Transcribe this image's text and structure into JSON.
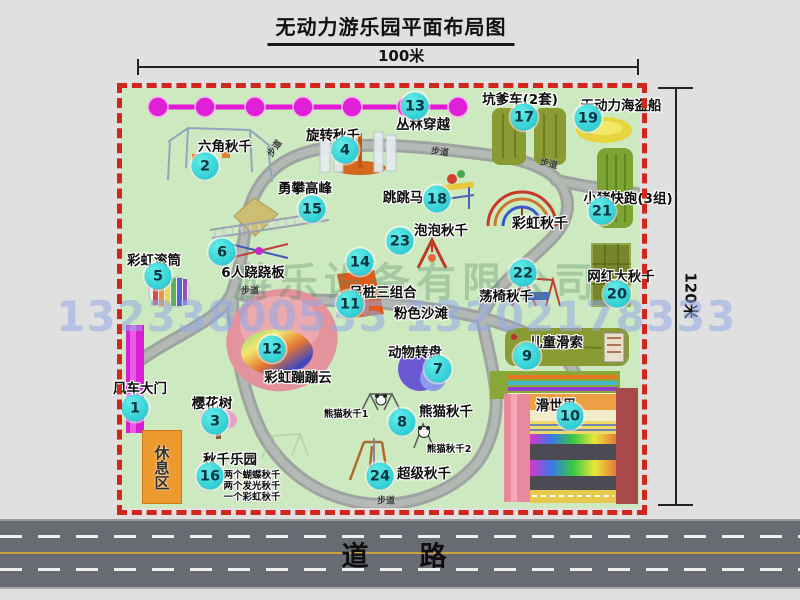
{
  "title": "无动力游乐园平面布局图",
  "scale": {
    "width_label": "100米",
    "height_label": "120米"
  },
  "road": {
    "label": "道　路"
  },
  "watermarks": {
    "company": "游乐设备有限公司",
    "phone": "13233800535 13202178333"
  },
  "map": {
    "walkway_label": "步道",
    "rest_area_label": "休息区",
    "attractions": [
      {
        "num": "1",
        "name": "风车大门",
        "bx": 13,
        "by": 320,
        "lx": 18,
        "ly": 299
      },
      {
        "num": "2",
        "name": "六角秋千",
        "bx": 83,
        "by": 78,
        "lx": 103,
        "ly": 57
      },
      {
        "num": "3",
        "name": "樱花树",
        "bx": 93,
        "by": 333,
        "lx": 90,
        "ly": 314
      },
      {
        "num": "4",
        "name": "旋转秋千",
        "bx": 223,
        "by": 62,
        "lx": 211,
        "ly": 46
      },
      {
        "num": "5",
        "name": "彩虹滚筒",
        "bx": 36,
        "by": 188,
        "lx": 32,
        "ly": 171
      },
      {
        "num": "6",
        "name": "6人跷跷板",
        "bx": 100,
        "by": 164,
        "lx": 131,
        "ly": 183
      },
      {
        "num": "7",
        "name": "动物转盘",
        "bx": 316,
        "by": 281,
        "lx": 293,
        "ly": 263
      },
      {
        "num": "8",
        "name": "熊猫秋千",
        "bx": 280,
        "by": 334,
        "lx": 324,
        "ly": 322
      },
      {
        "num": "9",
        "name": "儿童滑索",
        "bx": 405,
        "by": 268,
        "lx": 434,
        "ly": 253
      },
      {
        "num": "10",
        "name": "滑世界",
        "bx": 448,
        "by": 328,
        "lx": 434,
        "ly": 316
      },
      {
        "num": "11",
        "name": "粉色沙滩",
        "bx": 228,
        "by": 216,
        "lx": 299,
        "ly": 224
      },
      {
        "num": "12",
        "name": "彩虹蹦蹦云",
        "bx": 150,
        "by": 261,
        "lx": 176,
        "ly": 288
      },
      {
        "num": "13",
        "name": "丛林穿越",
        "bx": 293,
        "by": 18,
        "lx": 301,
        "ly": 35
      },
      {
        "num": "14",
        "name": "吊桩三组合",
        "bx": 238,
        "by": 174,
        "lx": 261,
        "ly": 203
      },
      {
        "num": "15",
        "name": "勇攀高峰",
        "bx": 190,
        "by": 121,
        "lx": 183,
        "ly": 99
      },
      {
        "num": "16",
        "name": "秋千乐园",
        "bx": 88,
        "by": 388,
        "lx": 108,
        "ly": 370
      },
      {
        "num": "17",
        "name": "坑爹车(2套)",
        "bx": 402,
        "by": 29,
        "lx": 398,
        "ly": 10
      },
      {
        "num": "18",
        "name": "跳跳马",
        "bx": 315,
        "by": 111,
        "lx": 281,
        "ly": 108
      },
      {
        "num": "19",
        "name": "无动力海盗船",
        "bx": 466,
        "by": 30,
        "lx": 499,
        "ly": 16
      },
      {
        "num": "20",
        "name": "网红大秋千",
        "bx": 495,
        "by": 206,
        "lx": 499,
        "ly": 187
      },
      {
        "num": "21",
        "name": "小猪快跑(3组)",
        "bx": 480,
        "by": 123,
        "lx": 506,
        "ly": 109
      },
      {
        "num": "22",
        "name": "荡椅秋千",
        "bx": 401,
        "by": 185,
        "lx": 384,
        "ly": 207
      },
      {
        "num": "23",
        "name": "泡泡秋千",
        "bx": 278,
        "by": 153,
        "lx": 319,
        "ly": 141
      },
      {
        "num": "24",
        "name": "超级秋千",
        "bx": 258,
        "by": 388,
        "lx": 302,
        "ly": 384
      }
    ],
    "extra_labels": [
      {
        "text": "彩虹秋千",
        "x": 418,
        "y": 135,
        "size": 14
      },
      {
        "text": "熊猫秋千1",
        "x": 224,
        "y": 325,
        "size": 9.5
      },
      {
        "text": "熊猫秋千2",
        "x": 327,
        "y": 360,
        "size": 9.5
      },
      {
        "text": "两个蝴蝶秋千",
        "x": 130,
        "y": 386,
        "size": 9.5
      },
      {
        "text": "两个发光秋千",
        "x": 130,
        "y": 397,
        "size": 9.5
      },
      {
        "text": "一个彩虹秋千",
        "x": 130,
        "y": 408,
        "size": 9.5
      }
    ],
    "walkway_positions": [
      {
        "x": 152,
        "y": 60,
        "rot": -55
      },
      {
        "x": 318,
        "y": 63,
        "rot": 8
      },
      {
        "x": 427,
        "y": 75,
        "rot": 14
      },
      {
        "x": 128,
        "y": 202,
        "rot": 0
      },
      {
        "x": 264,
        "y": 412,
        "rot": 0
      }
    ]
  },
  "colors": {
    "border_red": "#ce271c",
    "badge_cyan": "#22cfd4",
    "chain_magenta": "#e318d6",
    "grass_green": "#cde9c0",
    "road_gray": "#696b73",
    "gate_magenta": "#d91fd6",
    "rest_area_orange": "#ec9a2e"
  }
}
